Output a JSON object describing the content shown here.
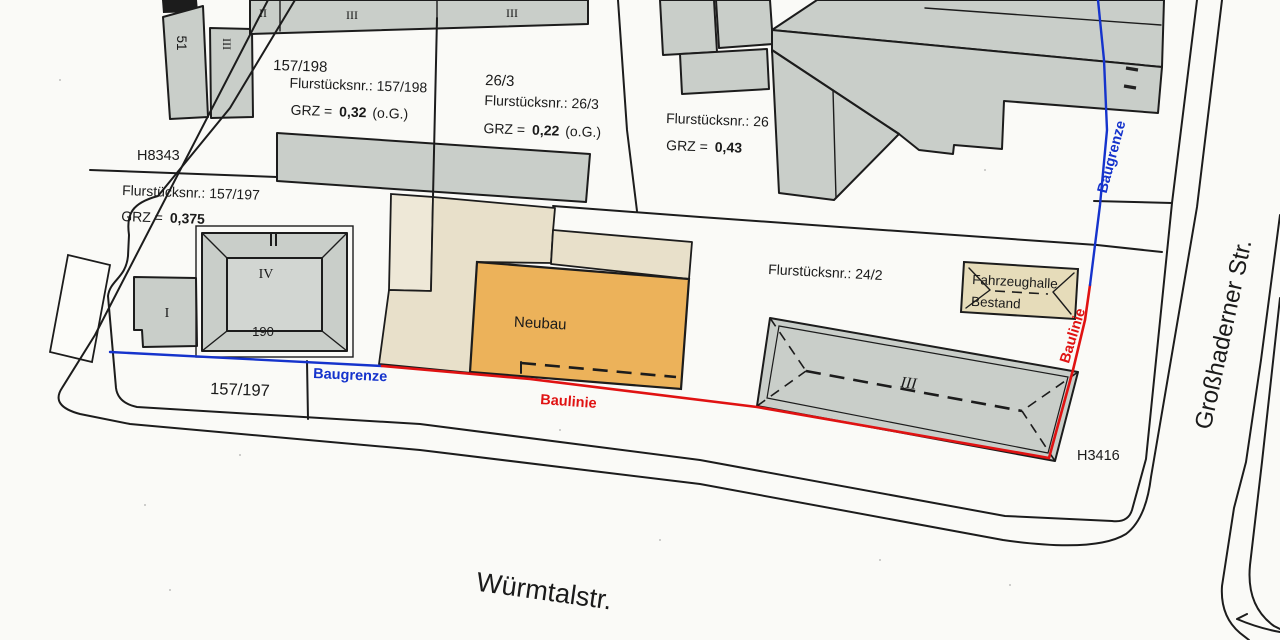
{
  "parcels": {
    "p157_198": {
      "number": "157/198",
      "flur": "Flurstücksnr.: 157/198",
      "grz_label": "GRZ =",
      "grz_value": "0,32",
      "grz_suffix": "(o.G.)"
    },
    "p26_3": {
      "number": "26/3",
      "flur": "Flurstücksnr.: 26/3",
      "grz_label": "GRZ =",
      "grz_value": "0,22",
      "grz_suffix": "(o.G.)"
    },
    "p26": {
      "flur": "Flurstücksnr.: 26",
      "grz_label": "GRZ =",
      "grz_value": "0,43"
    },
    "p157_197": {
      "flur": "Flurstücksnr.: 157/197",
      "grz_label": "GRZ =",
      "grz_value": "0,375",
      "number": "157/197"
    },
    "p24_2": {
      "flur": "Flurstücksnr.: 24/2"
    }
  },
  "markers": {
    "h8343": "H8343",
    "h3416": "H3416"
  },
  "buildings": {
    "neubau": "Neubau",
    "fahrzeughalle_line1": "Fahrzeughalle",
    "fahrzeughalle_line2": "Bestand",
    "house_number_51": "51",
    "storeys_rotated": "III",
    "top_band_storeys": [
      "II",
      "III",
      "III"
    ],
    "iv_storeys": "IV",
    "iv_number": "190",
    "small_storeys": "I",
    "hall_storeys": "III"
  },
  "boundary_labels": {
    "baugrenze_left": "Baugrenze",
    "baulinie_bottom": "Baulinie",
    "baulinie_right": "Baulinie",
    "baugrenze_right": "Baugrenze"
  },
  "streets": {
    "bottom": "Würmtalstr.",
    "right": "Großhaderner Str."
  },
  "colors": {
    "paper": "#fafaf7",
    "ink": "#1c1c1c",
    "building_gray": "#c9cec9",
    "roof_gray": "#d2d6d2",
    "tan": "#e8e0ca",
    "cream": "#eee8d7",
    "orange": "#ecb25a",
    "hall_beige": "#e6dcba",
    "baugrenze_blue": "#1533cc",
    "baulinie_red": "#e01212"
  }
}
